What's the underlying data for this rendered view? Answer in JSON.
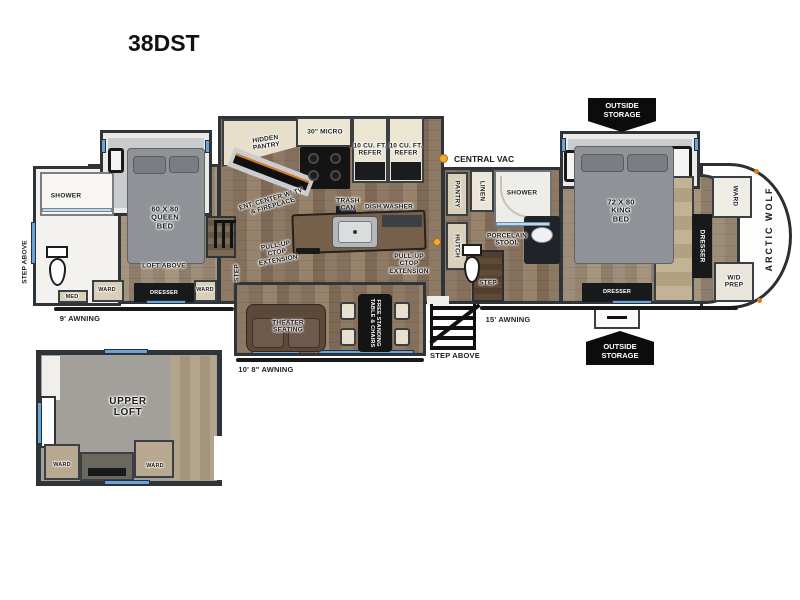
{
  "title": "38DST",
  "badges": {
    "outside_storage": "OUTSIDE\nSTORAGE"
  },
  "legend": {
    "central_vac": "CENTRAL VAC"
  },
  "exterior": {
    "awning_rear": "9' AWNING",
    "awning_mid": "10' 8\" AWNING",
    "awning_front": "15' AWNING",
    "step_above_rear": "STEP ABOVE",
    "step_above_entry": "STEP ABOVE",
    "brand": "ARCTIC WOLF"
  },
  "rear_bath": {
    "shower": "SHOWER",
    "med_cabinet": "MED"
  },
  "rear_bedroom": {
    "bed": "60 X 80\nQUEEN\nBED",
    "loft_above": "LOFT ABOVE",
    "ward_left": "WARD",
    "dresser": "DRESSER",
    "ward_right": "WARD",
    "step": "STEP"
  },
  "kitchen": {
    "hidden_pantry": "HIDDEN\nPANTRY",
    "microwave": "30\" MICRO",
    "refrigerator_left": "10 CU. FT.\nREFER",
    "refrigerator_right": "10 CU. FT.\nREFER",
    "ent_center": "ENT. CENTER W/ TV\n& FIREPLACE",
    "trash_can": "TRASH\nCAN",
    "dishwasher": "DISH WASHER",
    "ctop_extension_left": "PULL-UP\nCTOP\nEXTENSION",
    "ctop_extension_right": "PULL-UP\nCTOP\nEXTENSION"
  },
  "living": {
    "theater_seating": "THEATER\nSEATING",
    "table_chairs": "FREE STANDING\nTABLE & CHAIRS"
  },
  "mid_bath": {
    "pantry": "PANTRY",
    "hutch": "HUTCH",
    "linen": "LINEN",
    "shower": "SHOWER",
    "porcelain_stool": "PORCELAIN\nSTOOL",
    "step": "STEP"
  },
  "front_bedroom": {
    "bed": "72 X 80\nKING\nBED",
    "dresser_bottom": "DRESSER",
    "ward": "WARD",
    "dresser_side": "DRESSER",
    "wd_prep": "W/D\nPREP"
  },
  "upper_loft": {
    "name": "UPPER\nLOFT",
    "ward_left": "WARD",
    "ward_right": "WARD"
  },
  "colors": {
    "accent_window_blue": "#6aa3d8",
    "vac_dot": "#f2a934",
    "wall": "#2f3439",
    "badge_black": "#0c0c0c"
  }
}
